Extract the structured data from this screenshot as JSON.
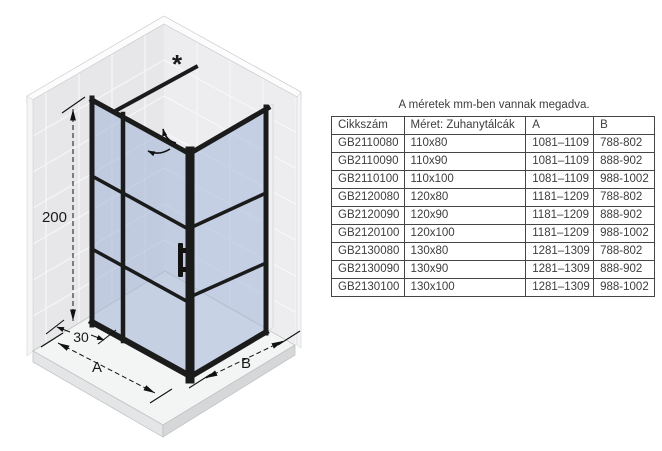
{
  "diagram": {
    "labels": {
      "height": "200",
      "fixed_width": "30",
      "width_a": "A",
      "width_b": "B",
      "asterisk": "*"
    },
    "colors": {
      "frame": "#1b1b1b",
      "glass": "#a8bcd9",
      "wall": "#e8e8ea",
      "tray": "#f3f4f4"
    }
  },
  "table": {
    "caption": "A méretek mm-ben vannak megadva.",
    "columns": [
      "Cikkszám",
      "Méret: Zuhanytálcák",
      "A",
      "B"
    ],
    "rows": [
      [
        "GB2110080",
        "110x80",
        "1081–1109",
        "788-802"
      ],
      [
        "GB2110090",
        "110x90",
        "1081–1109",
        "888-902"
      ],
      [
        "GB2110100",
        "110x100",
        "1081–1109",
        "988-1002"
      ],
      [
        "GB2120080",
        "120x80",
        "1181–1209",
        "788-802"
      ],
      [
        "GB2120090",
        "120x90",
        "1181–1209",
        "888-902"
      ],
      [
        "GB2120100",
        "120x100",
        "1181–1209",
        "988-1002"
      ],
      [
        "GB2130080",
        "130x80",
        "1281–1309",
        "788-802"
      ],
      [
        "GB2130090",
        "130x90",
        "1281–1309",
        "888-902"
      ],
      [
        "GB2130100",
        "130x100",
        "1281–1309",
        "988-1002"
      ]
    ]
  }
}
